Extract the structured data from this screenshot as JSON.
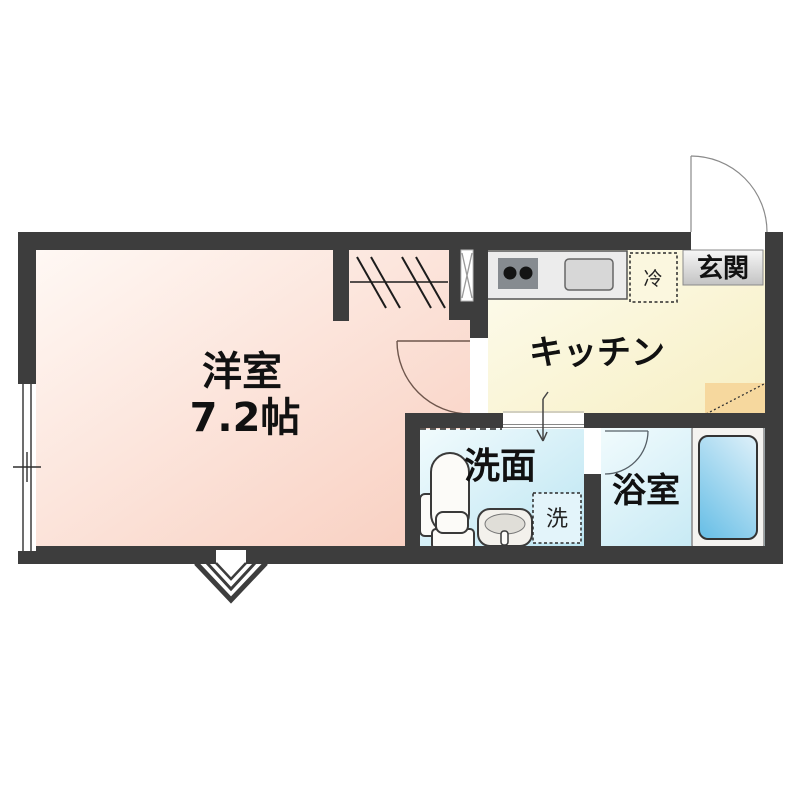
{
  "floor_plan": {
    "title": "1K apartment floor plan",
    "rooms": {
      "western_room": {
        "label": "洋室",
        "size_label": "7.2帖"
      },
      "kitchen": {
        "label": "キッチン"
      },
      "entrance": {
        "label": "玄関"
      },
      "washroom": {
        "label": "洗面"
      },
      "bathroom": {
        "label": "浴室"
      }
    },
    "appliance_markers": {
      "refrigerator": {
        "label": "冷"
      },
      "washing_machine": {
        "label": "洗"
      }
    },
    "colors": {
      "wall": "#3d3d3d",
      "western_room_fill_light": "#fff8f4",
      "western_room_fill_dark": "#f8cebf",
      "kitchen_fill_light": "#fdfcef",
      "kitchen_fill_dark": "#f7efc3",
      "wet_area_fill_light": "#f1fbfd",
      "wet_area_fill_dark": "#bce5f2",
      "genkan_floor": "#f6d89e",
      "bathtub_light": "#d6edf8",
      "bathtub_dark": "#6ec1e7",
      "entrance_label_bg_top": "#f7f7f7",
      "entrance_label_bg_bottom": "#c3c3c3",
      "counter_fill": "#ececec",
      "stove_fill": "#868b90",
      "text": "#111111"
    }
  }
}
